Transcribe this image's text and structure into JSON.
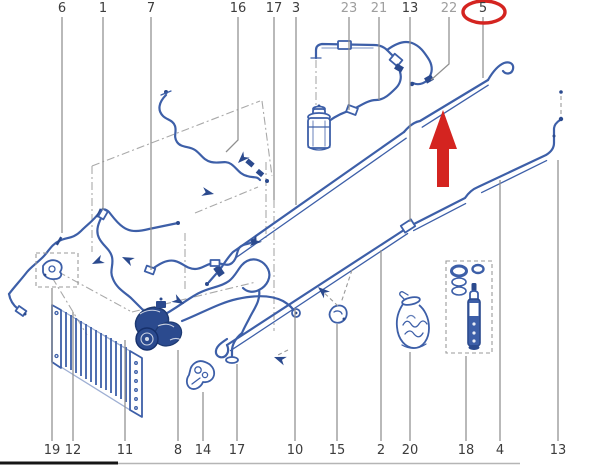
{
  "figure": {
    "kind": "exploded-parts-diagram",
    "background": "#ffffff",
    "tube_color": "#3d5fa8",
    "tube_dark_color": "#2b4a8e",
    "leader_color": "#8f8f8f",
    "label_color": "#3c3c3c",
    "label_muted_color": "#9e9e9e",
    "highlight_color": "#d42420"
  },
  "highlight": {
    "circled_part": "5",
    "ellipse": {
      "cx": 484,
      "cy": 12,
      "rx": 21,
      "ry": 11
    },
    "arrow": {
      "x": 443,
      "tip_y": 110,
      "head_base_y": 149,
      "base_y": 187,
      "head_half_width": 14,
      "shaft_half_width": 6
    }
  },
  "callouts_top": [
    {
      "part": "6",
      "x": 62,
      "line_end_y": 233,
      "muted": false
    },
    {
      "part": "1",
      "x": 103,
      "line_end_y": 210,
      "muted": false
    },
    {
      "part": "7",
      "x": 151,
      "line_end_y": 270,
      "muted": false
    },
    {
      "part": "16",
      "x": 238,
      "line_end_y": 140,
      "muted": false,
      "bend": {
        "x": 226,
        "y": 152
      }
    },
    {
      "part": "17",
      "x": 274,
      "line_end_y": 200,
      "muted": false
    },
    {
      "part": "3",
      "x": 296,
      "line_end_y": 205,
      "muted": false
    },
    {
      "part": "23",
      "x": 349,
      "line_end_y": 110,
      "muted": true
    },
    {
      "part": "21",
      "x": 379,
      "line_end_y": 100,
      "muted": true
    },
    {
      "part": "13",
      "x": 410,
      "line_end_y": 222,
      "muted": false
    },
    {
      "part": "22",
      "x": 449,
      "line_end_y": 64,
      "muted": true,
      "bend": {
        "x": 431,
        "y": 80
      }
    },
    {
      "part": "5",
      "x": 483,
      "line_end_y": 78,
      "muted": false,
      "circled": true
    }
  ],
  "callouts_bottom": [
    {
      "part": "19",
      "x": 52,
      "line_end_y": 288
    },
    {
      "part": "12",
      "x": 73,
      "line_end_y": 312
    },
    {
      "part": "11",
      "x": 125,
      "line_end_y": 340
    },
    {
      "part": "8",
      "x": 178,
      "line_end_y": 350
    },
    {
      "part": "14",
      "x": 203,
      "line_end_y": 392
    },
    {
      "part": "17",
      "x": 237,
      "line_end_y": 364
    },
    {
      "part": "10",
      "x": 295,
      "line_end_y": 308
    },
    {
      "part": "15",
      "x": 337,
      "line_end_y": 324
    },
    {
      "part": "2",
      "x": 381,
      "line_end_y": 250
    },
    {
      "part": "20",
      "x": 410,
      "line_end_y": 352
    },
    {
      "part": "18",
      "x": 466,
      "line_end_y": 356
    },
    {
      "part": "4",
      "x": 500,
      "line_end_y": 180
    },
    {
      "part": "13",
      "x": 558,
      "line_end_y": 160
    }
  ]
}
